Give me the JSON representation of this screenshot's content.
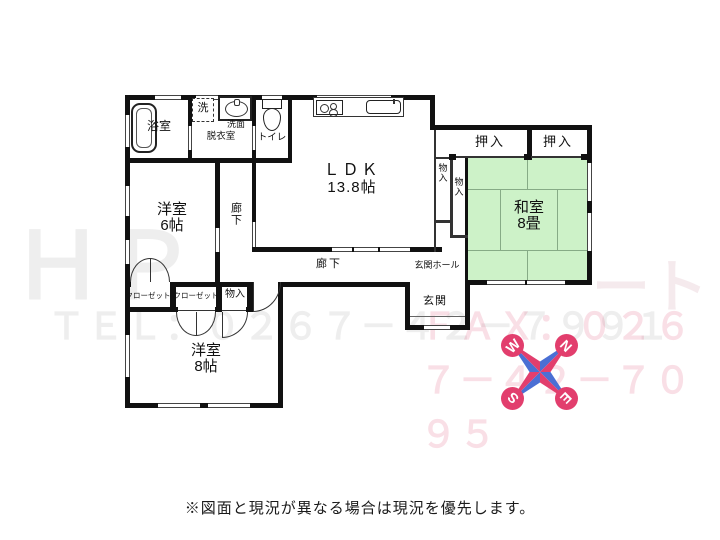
{
  "rooms": {
    "ldk": {
      "name": "ＬＤＫ",
      "size": "13.8帖"
    },
    "washitsu": {
      "name": "和室",
      "size": "8畳"
    },
    "yoshitsu6": {
      "name": "洋室",
      "size": "6帖"
    },
    "yoshitsu8": {
      "name": "洋室",
      "size": "8帖"
    },
    "bath": "浴室",
    "dressing": "脱衣室",
    "washbasin": "洗面",
    "laundry": "洗",
    "toilet": "トイレ",
    "oshiire": [
      "押入",
      "押入"
    ],
    "closets": [
      "クローゼット",
      "クローゼット"
    ],
    "monoire_hall": "物入",
    "monoire_side": [
      "物入",
      "物入"
    ],
    "corridor_vertical": "廊下",
    "corridor_horizontal": "廊下",
    "entrance_hall": "玄関ホール",
    "entrance": "玄関"
  },
  "compass": {
    "n": "N",
    "e": "E",
    "s": "S",
    "w": "W"
  },
  "watermark": {
    "left_big": "ＨＰ",
    "right_big": "ート",
    "tel": "ＴＥＬ：０２６７－４２－７９９１",
    "fax": "ＦＡＸ：０２６７－４２－７０９５"
  },
  "disclaimer": "※図面と現況が異なる場合は現況を優先します。",
  "colors": {
    "wall": "#111111",
    "tatami": "#cdf2c8",
    "tatami_line": "#86ab86",
    "compass_pink": "#e23e6d",
    "compass_blue": "#4a6fd4"
  }
}
